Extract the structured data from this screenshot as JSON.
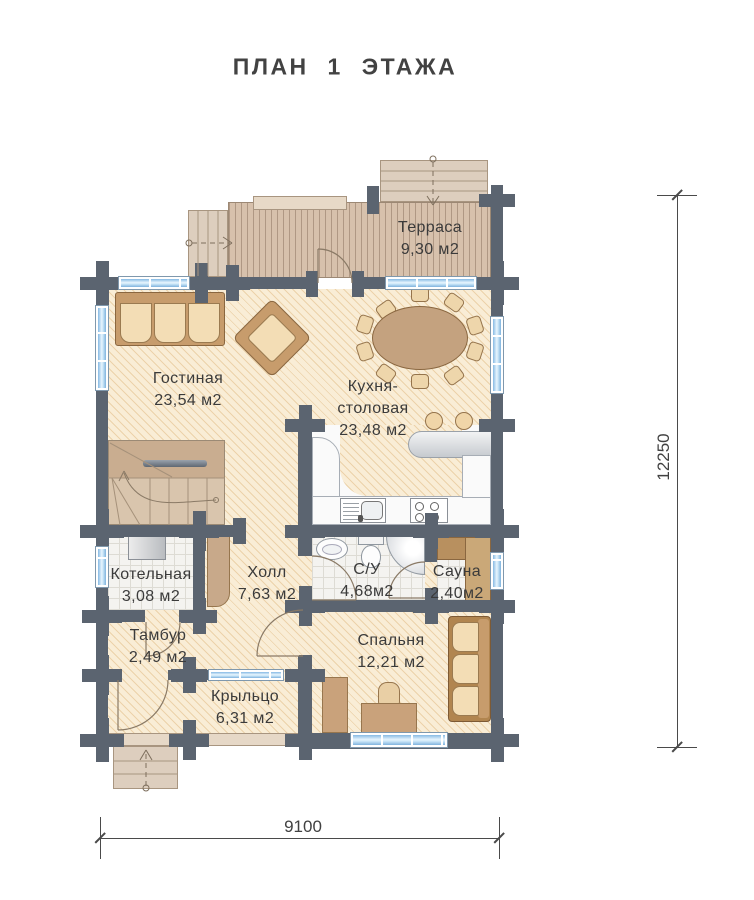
{
  "title": "ПЛАН  1  ЭТАЖА",
  "rooms": {
    "terrace": {
      "name": "Терраса",
      "area": "9,30 м2"
    },
    "living": {
      "name": "Гостиная",
      "area": "23,54 м2"
    },
    "kitchen": {
      "name_line1": "Кухня-",
      "name_line2": "столовая",
      "area": "23,48 м2"
    },
    "boiler": {
      "name": "Котельная",
      "area": "3,08 м2"
    },
    "hall": {
      "name": "Холл",
      "area": "7,63 м2"
    },
    "bathroom": {
      "name": "С/У",
      "area": "4,68м2"
    },
    "sauna": {
      "name": "Сауна",
      "area": "2,40м2"
    },
    "vestibule": {
      "name": "Тамбур",
      "area": "2,49 м2"
    },
    "bedroom": {
      "name": "Спальня",
      "area": "12,21 м2"
    },
    "porch": {
      "name": "Крыльцо",
      "area": "6,31 м2"
    }
  },
  "dimensions": {
    "vertical": "12250",
    "horizontal": "9100"
  },
  "colors": {
    "wall": "#5b6470",
    "window_glass": "#9fcdf0",
    "floor_hatch": "#f9edd6",
    "deck": "#d7c1ac"
  }
}
